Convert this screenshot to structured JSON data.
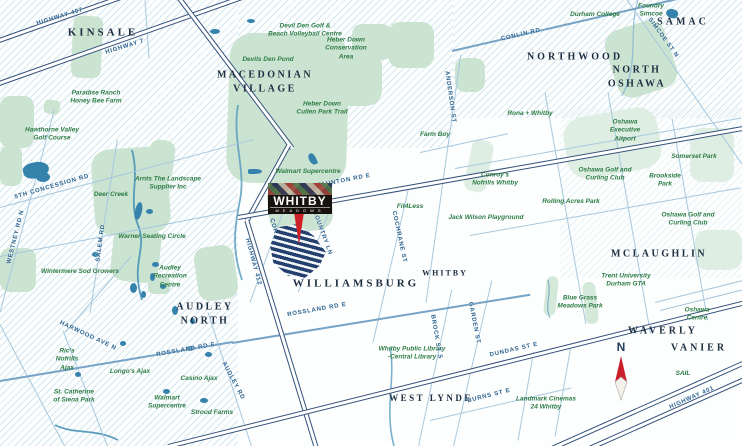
{
  "map_type": "location-map",
  "logo": {
    "title": "WHITBY",
    "subtitle": "MEADOWS"
  },
  "compass": {
    "label": "N"
  },
  "areas": {
    "kinsale": "KINSALE",
    "macedonian_village": "MACEDONIAN\nVILLAGE",
    "northwood": "NORTHWOOD",
    "north_oshawa": "NORTH OSHAWA",
    "samac": "SAMAC",
    "audley_north": "AUDLEY\nNORTH",
    "williamsburg": "WILLIAMSBURG",
    "whitby": "WHITBY",
    "mclaughlin": "MCLAUGHLIN",
    "west_lynde": "WEST LYNDE",
    "waverly": "WAVERLY",
    "vanier": "VANIER"
  },
  "pois": {
    "paradise_ranch": "Paradise Ranch\nHoney Bee Farm",
    "hawthorne": "Hawthorne Valley\nGolf Course",
    "devil_den": "Devil Den Golf &\nBeach Volleyball Centre",
    "devils_den_pond": "Devils Den Pond",
    "heber_down_ca": "Heber Down\nConservation\nArea",
    "heber_down_trail": "Heber Down\nCullen Park Trail",
    "durham_college": "Durham College",
    "foundry_simcoe": "Foundry\nSimcoe",
    "arnts": "Arnts The Landscape\nSupplier Inc",
    "deer_creek": "Deer Creek",
    "warner": "Warner Seating Circle",
    "walmart_north": "Walmart Supercentre",
    "farm_boy": "Farm Boy",
    "rona": "Rona + Whitby",
    "oshawa_exec": "Oshawa\nExecutive\nAitport",
    "somerset": "Somerset Park",
    "oshawa_golf_n": "Oshawa Golf and\nCurling Club",
    "brookside": "Brookside\nPark",
    "conroys": "Conroy's\nNofrills Whitby",
    "rolling_acres": "Rolling Acres Park",
    "jack_wilson": "Jack Wilson Playground",
    "fit4less": "Fit4Less",
    "oshawa_golf_s": "Oshawa Golf and\nCurling Club",
    "trent": "Trent University\nDurham GTA",
    "blue_grass": "Blue Grass\nMeadows Park",
    "oshawa_centre": "Oshawa Centre",
    "sail": "SAIL",
    "landmark": "Landmark Cinemas\n24 Whitby",
    "whitby_library": "Whitby Public Library\n-Central Library",
    "wintermere": "Wintermere Sod Growers",
    "audley_rec": "Audley\nRecreation\nCentre",
    "rics": "Ric's\nNofrills\nAjax",
    "longos": "Longo's Ajax",
    "casino": "Casino Ajax",
    "walmart_south": "Walmart\nSupercentre",
    "stroud": "Stroud Farms",
    "st_catherine": "St. Catherine\nof Siena Park"
  },
  "roads": {
    "hwy407": "HIGHWAY 407",
    "hwy7": "HIGHWAY 7",
    "concession5": "5TH CONCESSION RD",
    "westney": "WESTNEY RD N",
    "salem": "SALEM RD",
    "harwood": "HARWOOD AVE N",
    "audley_rd": "AUDLEY RD",
    "rossland_w": "ROSSLAND RD E",
    "rossland_c": "ROSSLAND RD E",
    "hwy412": "HIGHWAY 412",
    "coronation": "CORONATION RD",
    "country_ln": "COUNTRY LN",
    "cochrane": "COCHRANE ST",
    "taunton": "TAUNTON RD E",
    "anderson": "ANDERSON ST",
    "conlin": "CONLIN RD",
    "simcoe": "SIMCOE ST N",
    "brock": "BROCK ST S",
    "garden": "GARDEN ST",
    "dundas": "DUNDAS ST E",
    "burns": "BURNS ST E",
    "hwy401": "HIGHWAY 401"
  },
  "colors": {
    "area_label": "#1d2e41",
    "poi_label": "#2d7c45",
    "road_label": "#2a618f",
    "road_outline": "#33517a",
    "green_fill": "#cbe3d1",
    "water": "#3583ad",
    "site_stripe": "#24406f",
    "pin_red": "#ce2027",
    "logo_bg": "#17120e"
  }
}
